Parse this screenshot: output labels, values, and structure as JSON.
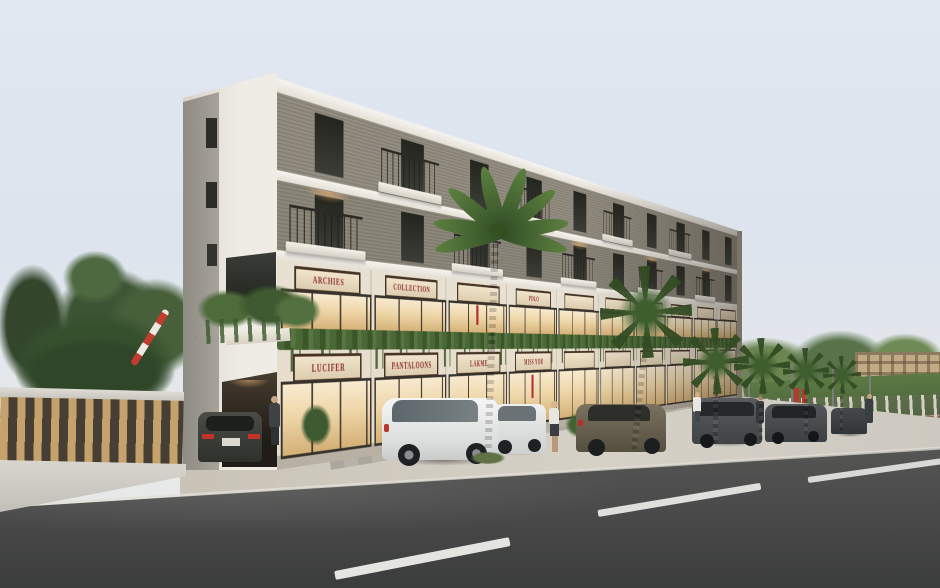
{
  "scene": {
    "description": "Dusk architectural rendering of a 3-storey mixed-use building with two levels of lit retail shopfronts, hanging planters, palm-lined forecourt, parked cars and an asphalt road in the foreground",
    "setting": "street exterior",
    "lighting": "overcast dusk with warm interior shop lighting"
  },
  "building": {
    "floors": 3,
    "retail_levels": 2,
    "upper_signs": [
      {
        "label": "ARCHIES"
      },
      {
        "label": "COLLECTION"
      },
      {
        "label": ""
      },
      {
        "label": "POLO"
      },
      {
        "label": ""
      },
      {
        "label": ""
      },
      {
        "label": ""
      },
      {
        "label": ""
      },
      {
        "label": ""
      },
      {
        "label": ""
      }
    ],
    "ground_signs": [
      {
        "label": "LUCIFER"
      },
      {
        "label": "PANTALOONS"
      },
      {
        "label": "LAKME"
      },
      {
        "label": "MISS YOU"
      },
      {
        "label": ""
      },
      {
        "label": ""
      },
      {
        "label": ""
      },
      {
        "label": ""
      },
      {
        "label": ""
      },
      {
        "label": ""
      }
    ]
  },
  "street": {
    "vehicles": [
      {
        "type": "sedan",
        "color": "dark grey",
        "location": "entrance driveway"
      },
      {
        "type": "hatchback",
        "color": "white",
        "location": "forecourt"
      },
      {
        "type": "compact",
        "color": "white",
        "location": "forecourt"
      },
      {
        "type": "sedan",
        "color": "olive brown",
        "location": "kerb"
      },
      {
        "type": "minivan",
        "color": "grey",
        "location": "kerb"
      },
      {
        "type": "sedan",
        "color": "charcoal",
        "location": "kerb"
      },
      {
        "type": "sedan",
        "color": "charcoal",
        "location": "kerb far"
      }
    ],
    "pedestrians": [
      {
        "description": "man in dark suit at building entrance"
      },
      {
        "description": "woman walking on forecourt"
      },
      {
        "description": "woman in white on right sidewalk"
      },
      {
        "description": "man in distance on right sidewalk"
      }
    ],
    "palm_count": 6,
    "lane_dash_count": 3,
    "barrier": "red and white boom barrier, raised"
  },
  "colors": {
    "sky_top": "#e2e8f1",
    "brick": "#8e887b",
    "white_band": "#f4f2ed",
    "shop_glass_warm": "#eed6a8",
    "sign_face": "#ead9bf",
    "sign_text_red": "#8c2c2c",
    "sign_frame": "#463226",
    "hedge_green": "#46612f",
    "fence_wood": "#c5a26b",
    "road_asphalt": "#454645",
    "lane_marking": "#e4e5e1"
  }
}
